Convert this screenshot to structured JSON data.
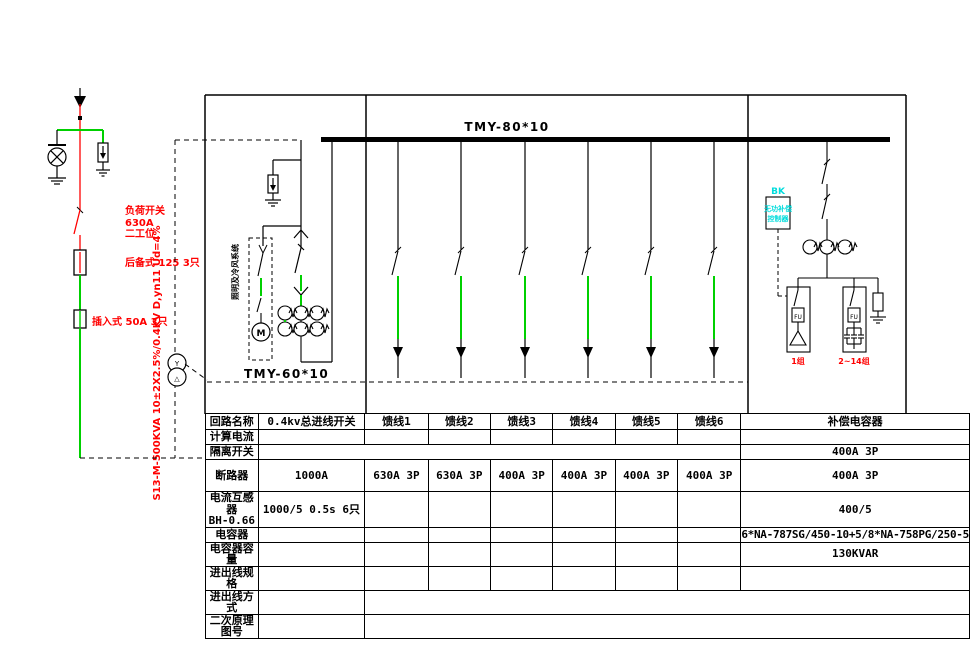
{
  "colors": {
    "line_green": "#00d000",
    "cad_red": "#ff0000",
    "cad_cyan": "#00dcdc",
    "line_black": "#000000"
  },
  "labels": {
    "bus_main": "TMY-80*10",
    "bus_lv": "TMY-60*10",
    "load_switch_l1": "负荷开关",
    "load_switch_l2": "630A",
    "load_switch_l3": "二工位",
    "fuse_backup": "后备式 125 3只",
    "fuse_plugin": "插入式 50A 3只",
    "transformer_spec": "S13-M-500KVA 10±2X2.5%/0.4KV D,yn11 Ud=4%",
    "transformer_hv": "Y",
    "transformer_lv": "△",
    "lighting_branch": "照明及冷风系统",
    "motor": "M",
    "bk_title": "BK",
    "bk_l1": "无功补偿",
    "bk_l2": "控制器",
    "fuse_box": "FU",
    "cap_group_1": "1组",
    "cap_group_2": "2~14组"
  },
  "table": {
    "row_labels": [
      "回路名称",
      "计算电流",
      "隔离开关",
      "断路器",
      "电流互感器",
      "电容器",
      "电容器容量",
      "进出线规格",
      "进出线方式",
      "二次原理图号"
    ],
    "ct_sublabel": "BH-0.66",
    "header_cells": [
      "0.4kv总进线开关",
      "馈线1",
      "馈线2",
      "馈线3",
      "馈线4",
      "馈线5",
      "馈线6",
      "补偿电容器"
    ],
    "isolator_capacitor": "400A 3P",
    "breaker_cells": [
      "1000A",
      "630A 3P",
      "630A 3P",
      "400A 3P",
      "400A 3P",
      "400A 3P",
      "400A 3P",
      "400A 3P"
    ],
    "ct_main": "1000/5 0.5s 6只",
    "ct_capacitor": "400/5",
    "capacitor_model": "6*NA-787SG/450-10+5/8*NA-758PG/250-5",
    "capacitor_capacity": "130KVAR"
  }
}
